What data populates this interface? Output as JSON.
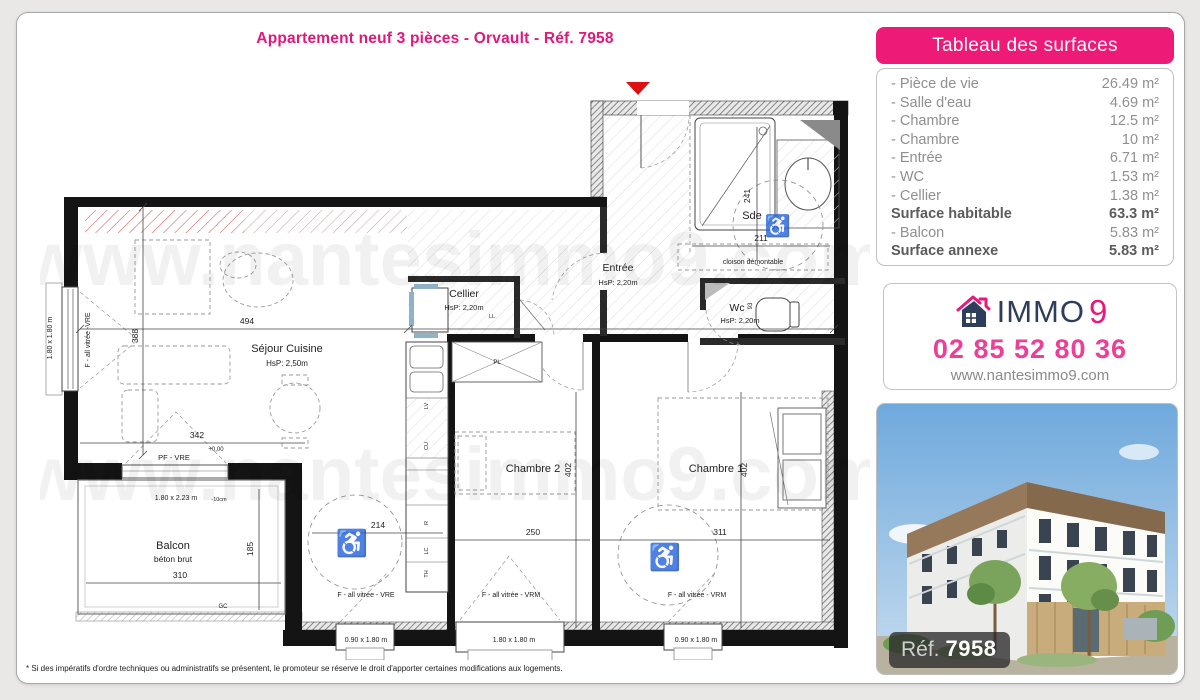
{
  "page": {
    "title": "Appartement neuf 3 pièces - Orvault - Réf. 7958",
    "footnote": "* Si des impératifs d'ordre techniques ou administratifs se présentent, le promoteur se réserve le droit d'apporter certaines modifications aux logements."
  },
  "colors": {
    "accent_pink": "#ed1a78",
    "title_pink": "#e0187a",
    "phone_pink": "#ee3f98",
    "brand_navy": "#2e3d59",
    "entrance_marker_red": "#dd1111"
  },
  "surface_table": {
    "header": "Tableau des surfaces",
    "rows": [
      {
        "label": "- Pièce de vie",
        "value": "26.49 m²",
        "bold": false
      },
      {
        "label": "- Salle d'eau",
        "value": "4.69 m²",
        "bold": false
      },
      {
        "label": "- Chambre",
        "value": "12.5 m²",
        "bold": false
      },
      {
        "label": "- Chambre",
        "value": "10 m²",
        "bold": false
      },
      {
        "label": "- Entrée",
        "value": "6.71 m²",
        "bold": false
      },
      {
        "label": "- WC",
        "value": "1.53 m²",
        "bold": false
      },
      {
        "label": "- Cellier",
        "value": "1.38 m²",
        "bold": false
      },
      {
        "label": "Surface habitable",
        "value": "63.3 m²",
        "bold": true
      },
      {
        "label": "- Balcon",
        "value": "5.83 m²",
        "bold": false
      },
      {
        "label": "Surface annexe",
        "value": "5.83 m²",
        "bold": true
      }
    ]
  },
  "agency": {
    "brand": "IMMO",
    "brand_digit": "9",
    "phone": "02 85 52 80 36",
    "website": "www.nantesimmo9.com"
  },
  "photo": {
    "ref_label": "Réf.",
    "ref_number": "7958"
  },
  "floorplan": {
    "watermark": "www.nantesimmo9.com",
    "labels": [
      {
        "t": "www.nantesimmo9.com",
        "x": 455,
        "y": 285,
        "s": 76,
        "c": "wm"
      },
      {
        "t": "www.nantesimmo9.com",
        "x": 455,
        "y": 500,
        "s": 76,
        "c": "wm"
      },
      {
        "t": "Séjour Cuisine",
        "x": 287,
        "y": 352,
        "s": 11
      },
      {
        "t": "HsP: 2,50m",
        "x": 287,
        "y": 366,
        "s": 8
      },
      {
        "t": "Cellier",
        "x": 464,
        "y": 297,
        "s": 10.5
      },
      {
        "t": "HsP: 2,20m",
        "x": 464,
        "y": 310,
        "s": 7.5
      },
      {
        "t": "Entrée",
        "x": 618,
        "y": 271,
        "s": 10.5
      },
      {
        "t": "HsP: 2,20m",
        "x": 618,
        "y": 285,
        "s": 7.5
      },
      {
        "t": "Sde",
        "x": 752,
        "y": 219,
        "s": 11
      },
      {
        "t": "Wc",
        "x": 737,
        "y": 311,
        "s": 10.5
      },
      {
        "t": "HsP: 2,20m",
        "x": 740,
        "y": 323,
        "s": 7.5
      },
      {
        "t": "Chambre 2",
        "x": 533,
        "y": 472,
        "s": 11
      },
      {
        "t": "Chambre 1",
        "x": 716,
        "y": 472,
        "s": 11
      },
      {
        "t": "Balcon",
        "x": 173,
        "y": 549,
        "s": 11
      },
      {
        "t": "béton brut",
        "x": 173,
        "y": 562,
        "s": 8.5
      },
      {
        "t": "cloison démontable",
        "x": 753,
        "y": 264,
        "s": 7
      },
      {
        "t": "494",
        "x": 247,
        "y": 324,
        "s": 8.5
      },
      {
        "t": "388",
        "x": 138,
        "y": 336,
        "s": 8.5,
        "r": -90
      },
      {
        "t": "342",
        "x": 197,
        "y": 438,
        "s": 8.5
      },
      {
        "t": "+0,00",
        "x": 216,
        "y": 451,
        "s": 6
      },
      {
        "t": "310",
        "x": 180,
        "y": 578,
        "s": 8.5
      },
      {
        "t": "185",
        "x": 253,
        "y": 549,
        "s": 8.5,
        "r": -90
      },
      {
        "t": "GC",
        "x": 223,
        "y": 608,
        "s": 6
      },
      {
        "t": "1.80 x 2.23 m",
        "x": 176,
        "y": 500,
        "s": 7
      },
      {
        "t": "-10cm",
        "x": 219,
        "y": 501,
        "s": 5.5
      },
      {
        "t": "241",
        "x": 750,
        "y": 196,
        "s": 8.5,
        "r": -90
      },
      {
        "t": "211",
        "x": 761,
        "y": 241,
        "s": 8.5
      },
      {
        "t": "250",
        "x": 533,
        "y": 535,
        "s": 8.5
      },
      {
        "t": "311",
        "x": 720,
        "y": 535,
        "s": 8.5
      },
      {
        "t": "402",
        "x": 571,
        "y": 470,
        "s": 8.5,
        "r": -90
      },
      {
        "t": "402",
        "x": 747,
        "y": 470,
        "s": 8.5,
        "r": -90
      },
      {
        "t": "214",
        "x": 378,
        "y": 528,
        "s": 8.5
      },
      {
        "t": "1.80 x 1.80 m",
        "x": 52,
        "y": 338,
        "s": 7,
        "r": -90
      },
      {
        "t": "0.90 x 1.80 m",
        "x": 366,
        "y": 642,
        "s": 7
      },
      {
        "t": "1.80 x 1.80 m",
        "x": 514,
        "y": 642,
        "s": 7
      },
      {
        "t": "0.90 x 1.80 m",
        "x": 696,
        "y": 642,
        "s": 7
      },
      {
        "t": "F - all vitrée -VRE",
        "x": 90,
        "y": 340,
        "s": 7,
        "r": -90
      },
      {
        "t": "PF - VRE",
        "x": 174,
        "y": 460,
        "s": 7.5
      },
      {
        "t": "F - all vitrée - VRE",
        "x": 366,
        "y": 597,
        "s": 7
      },
      {
        "t": "F - all vitrée - VRM",
        "x": 511,
        "y": 597,
        "s": 7
      },
      {
        "t": "F - all vitrée - VRM",
        "x": 697,
        "y": 597,
        "s": 7
      },
      {
        "t": "LL",
        "x": 492,
        "y": 318,
        "s": 5.5
      },
      {
        "t": "PL",
        "x": 497,
        "y": 364,
        "s": 6
      },
      {
        "t": "LV",
        "x": 428,
        "y": 406,
        "s": 5.5,
        "r": -90
      },
      {
        "t": "CU",
        "x": 428,
        "y": 446,
        "s": 5.5,
        "r": -90
      },
      {
        "t": "R",
        "x": 428,
        "y": 523,
        "s": 5.5,
        "r": -90
      },
      {
        "t": "LC",
        "x": 428,
        "y": 551,
        "s": 5.5,
        "r": -90
      },
      {
        "t": "TH",
        "x": 428,
        "y": 574,
        "s": 5.5,
        "r": -90
      },
      {
        "t": "93",
        "x": 752,
        "y": 306,
        "s": 6,
        "r": -90
      },
      {
        "t": "♿",
        "x": 352,
        "y": 552,
        "s": 26,
        "c": "wc"
      },
      {
        "t": "♿",
        "x": 665,
        "y": 566,
        "s": 26,
        "c": "wc"
      },
      {
        "t": "♿",
        "x": 778,
        "y": 233,
        "s": 21,
        "c": "wc"
      }
    ]
  }
}
